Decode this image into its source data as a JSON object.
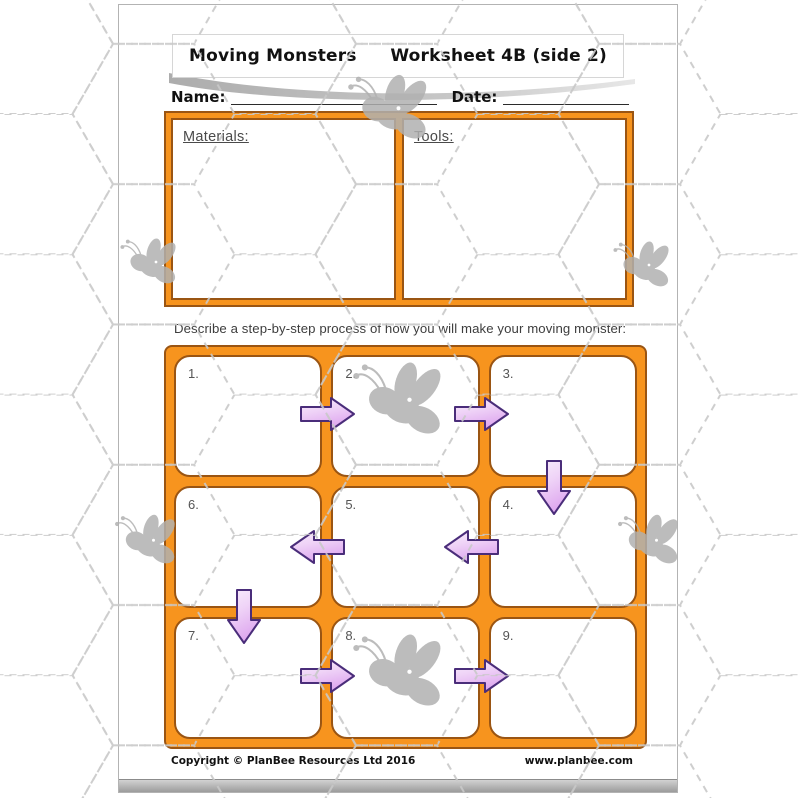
{
  "page": {
    "header": {
      "title": "Moving Monsters",
      "worksheet_label": "Worksheet 4B (side 2)"
    },
    "fields": {
      "name_label": "Name:",
      "date_label": "Date:"
    },
    "supplies": {
      "materials_label": "Materials:",
      "tools_label": "Tools:"
    },
    "instruction": "Describe a step-by-step process of how you will make your moving monster:",
    "grid": {
      "steps": [
        "1.",
        "2.",
        "3.",
        "4.",
        "5.",
        "6.",
        "7.",
        "8.",
        "9."
      ]
    },
    "flow_arrows": [
      {
        "from": 1,
        "to": 2,
        "direction": "right"
      },
      {
        "from": 2,
        "to": 3,
        "direction": "right"
      },
      {
        "from": 3,
        "to": 4,
        "direction": "down"
      },
      {
        "from": 4,
        "to": 5,
        "direction": "left"
      },
      {
        "from": 5,
        "to": 6,
        "direction": "left"
      },
      {
        "from": 6,
        "to": 7,
        "direction": "down"
      },
      {
        "from": 7,
        "to": 8,
        "direction": "right"
      },
      {
        "from": 8,
        "to": 9,
        "direction": "right"
      }
    ],
    "footer": {
      "copyright": "Copyright © PlanBee Resources Ltd 2016",
      "website": "www.planbee.com"
    },
    "colors": {
      "accent_orange": "#F7941E",
      "frame_border": "#9A5513",
      "arrow_fill_light": "#F8EEFC",
      "arrow_fill_dark": "#DEA7EF",
      "arrow_outline": "#4A2D7A",
      "watermark_gray": "#C8C8C8",
      "bee_gray": "#B0B0B0"
    },
    "watermark": {
      "pattern": "dashed-hexagons",
      "bee_icon_count": 7
    }
  }
}
